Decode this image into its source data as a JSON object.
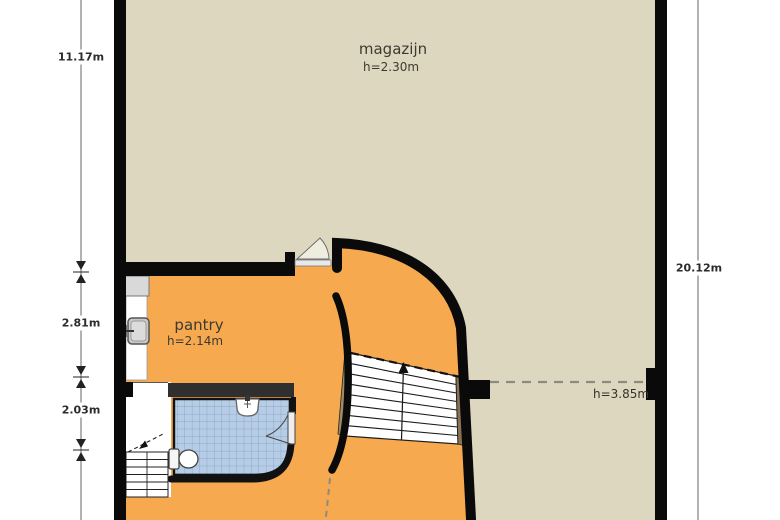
{
  "plan": {
    "rooms": [
      {
        "id": "magazijn",
        "name": "magazijn",
        "ceiling": "h=2.30m"
      },
      {
        "id": "pantry",
        "name": "pantry",
        "ceiling": "h=2.14m"
      }
    ],
    "zone_note": "h=3.85m",
    "dimensions": {
      "left_upper": "11.17m",
      "left_middle": "2.81m",
      "left_lower": "2.03m",
      "right": "20.12m"
    },
    "colors": {
      "magazijn_floor": "#ded7c0",
      "pantry_floor": "#f7a94f",
      "tile": "#b7cde5",
      "tile_grid": "#87a9cc",
      "wall": "#0a0a0a",
      "wall_soft": "#2f2f2f",
      "wood": "#8a7154",
      "wood_light": "#a08a68",
      "dash": "#8d8b7e",
      "fixture_gray": "#d9d9d9"
    }
  }
}
